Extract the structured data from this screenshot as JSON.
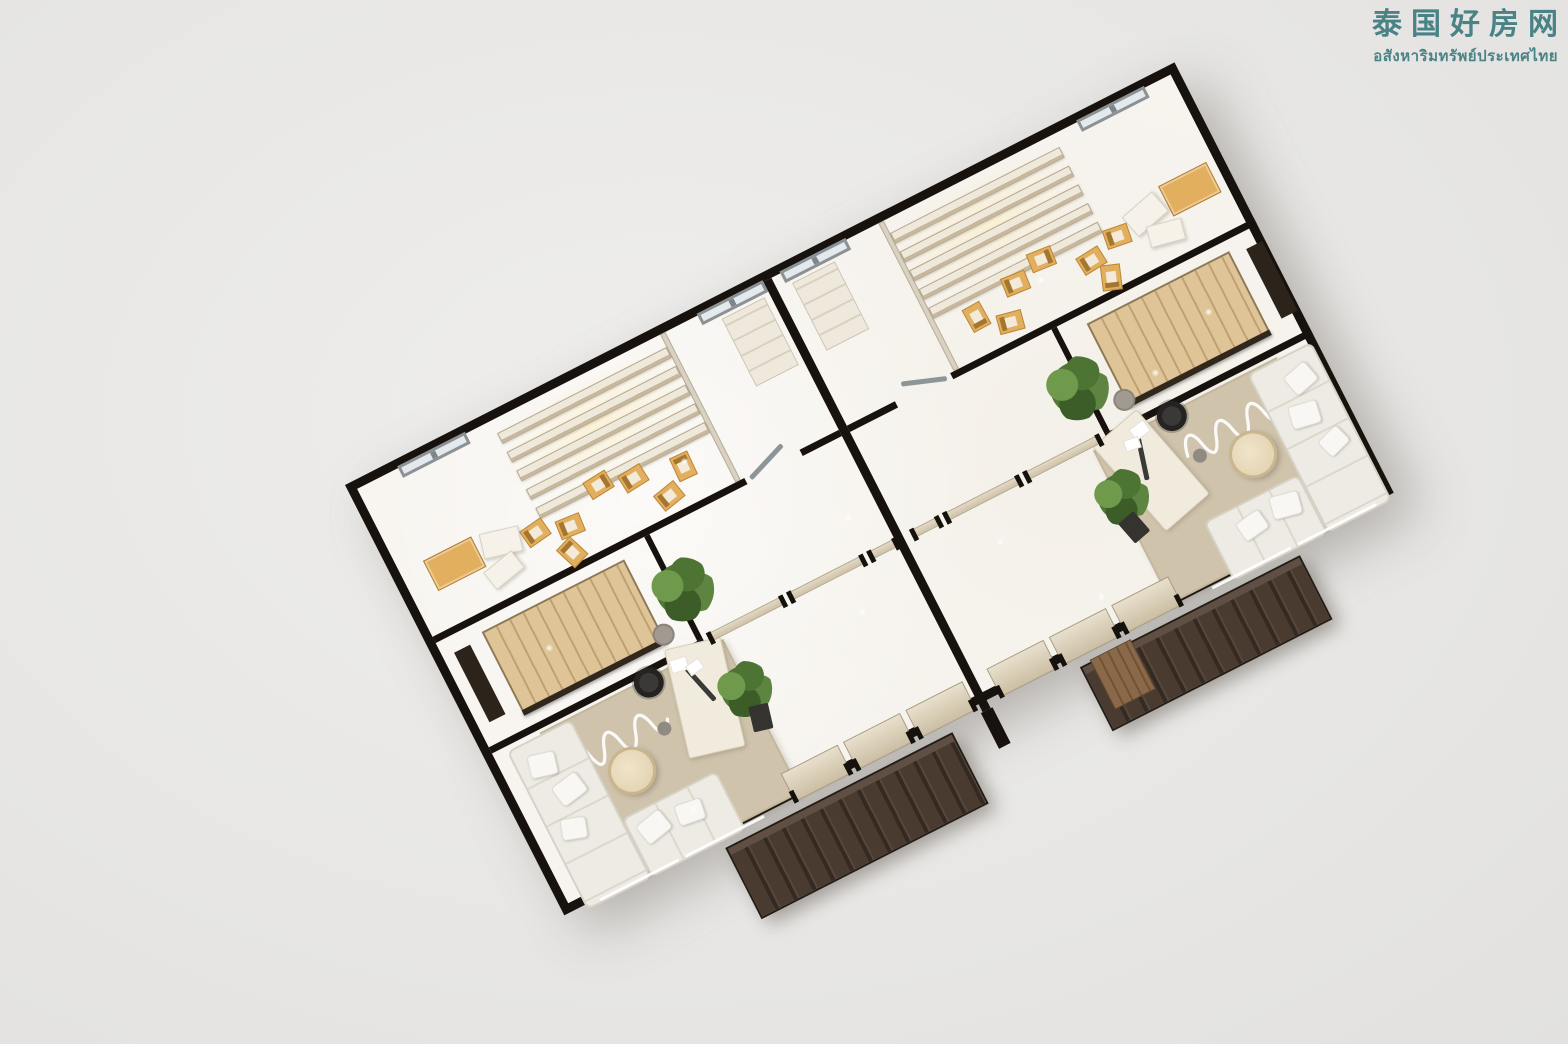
{
  "watermark": {
    "title_zh": "泰国好房网",
    "subtitle_th": "อสังหาริมทรัพย์ประเทศไทย",
    "color": "#3e7c80"
  },
  "palette": {
    "wall": "#17120d",
    "floor": "#f7f4ef",
    "rug": "#cfc3ac",
    "sofa": "#edebe4",
    "wood": "#dfc497",
    "tan": "#e2af5e",
    "awn1": "#4a3b31",
    "awn2": "#342a22",
    "deck": "#8a684a",
    "plant": "#517739",
    "part": "#cfc2a8",
    "wm": "#3e7c80",
    "winframe": "#8b9194"
  },
  "plan": {
    "left": 345,
    "top": 485,
    "width": 931,
    "height": 483,
    "angle_deg": -27,
    "border_px": 9
  },
  "items": [
    {
      "n": "spotlight-glow-left",
      "t": "glow",
      "x": 138,
      "y": 8,
      "w": 214,
      "h": 100
    },
    {
      "n": "spotlight-glow-right",
      "t": "glow",
      "x": 579,
      "y": 8,
      "w": 214,
      "h": 100
    },
    {
      "n": "rug-left-unit",
      "t": "rug",
      "x": 52,
      "y": 300,
      "w": 206,
      "h": 172
    },
    {
      "n": "rug-right-unit",
      "t": "rug",
      "x": 673,
      "y": 300,
      "w": 206,
      "h": 172
    },
    {
      "n": "rug-squiggle-left",
      "t": "squiggle",
      "x": 62,
      "y": 318,
      "w": 120,
      "h": 52
    },
    {
      "n": "rug-squiggle-right",
      "t": "squiggle",
      "x": 749,
      "y": 318,
      "w": 120,
      "h": 52
    },
    {
      "n": "party-wall",
      "t": "wall",
      "x": 456,
      "y": 0,
      "w": 9,
      "h": 483
    },
    {
      "n": "party-wall-stub",
      "t": "stub",
      "x": 454,
      "y": 483,
      "w": 13,
      "h": 40
    },
    {
      "n": "wall-a-left-1",
      "t": "wall",
      "x": 0,
      "y": 166,
      "w": 350,
      "h": 7
    },
    {
      "n": "wall-a-left-2",
      "t": "wall",
      "x": 412,
      "y": 166,
      "w": 44,
      "h": 7
    },
    {
      "n": "wall-a-right-1",
      "t": "wall",
      "x": 465,
      "y": 166,
      "w": 54,
      "h": 7
    },
    {
      "n": "wall-a-right-2",
      "t": "wall",
      "x": 581,
      "y": 166,
      "w": 341,
      "h": 7
    },
    {
      "n": "wall-b-left",
      "t": "wall",
      "x": 0,
      "y": 290,
      "w": 240,
      "h": 7
    },
    {
      "n": "wall-b-right",
      "t": "wall",
      "x": 691,
      "y": 290,
      "w": 231,
      "h": 7
    },
    {
      "n": "stair-wall-left",
      "t": "wall",
      "x": 234,
      "y": 173,
      "w": 6,
      "h": 117
    },
    {
      "n": "stair-wall-right",
      "t": "wall",
      "x": 691,
      "y": 173,
      "w": 6,
      "h": 117
    },
    {
      "n": "backroom-divider-left",
      "t": "wall-light",
      "x": 340,
      "y": 0,
      "w": 6,
      "h": 166
    },
    {
      "n": "backroom-divider-right",
      "t": "wall-light",
      "x": 585,
      "y": 0,
      "w": 6,
      "h": 166
    },
    {
      "n": "door-leaf-left",
      "t": "door",
      "x": 354,
      "y": 159,
      "w": 46,
      "h": 5,
      "r": -20
    },
    {
      "n": "door-leaf-right",
      "t": "door",
      "x": 531,
      "y": 159,
      "w": 46,
      "h": 5,
      "r": 20
    },
    {
      "n": "window-back-left-outer",
      "t": "window",
      "x": 46,
      "y": -2,
      "w": 76,
      "h": 13
    },
    {
      "n": "window-back-left-inner",
      "t": "window",
      "x": 382,
      "y": -2,
      "w": 74,
      "h": 13
    },
    {
      "n": "window-back-right-inner",
      "t": "window",
      "x": 475,
      "y": -2,
      "w": 74,
      "h": 13
    },
    {
      "n": "window-back-right-outer",
      "t": "window",
      "x": 808,
      "y": -2,
      "w": 76,
      "h": 13
    },
    {
      "n": "shelf-row-left-1",
      "t": "shelfrow",
      "x": 150,
      "y": 14,
      "w": 190,
      "h": 12
    },
    {
      "n": "shelf-row-left-2",
      "t": "shelfrow",
      "x": 150,
      "y": 35,
      "w": 190,
      "h": 12
    },
    {
      "n": "shelf-row-left-3",
      "t": "shelfrow",
      "x": 150,
      "y": 56,
      "w": 190,
      "h": 12
    },
    {
      "n": "shelf-row-left-4",
      "t": "shelfrow",
      "x": 150,
      "y": 77,
      "w": 190,
      "h": 12
    },
    {
      "n": "shelf-row-left-5",
      "t": "shelfrow",
      "x": 150,
      "y": 98,
      "w": 190,
      "h": 12
    },
    {
      "n": "shelf-row-right-1",
      "t": "shelfrow",
      "x": 591,
      "y": 14,
      "w": 190,
      "h": 12
    },
    {
      "n": "shelf-row-right-2",
      "t": "shelfrow",
      "x": 591,
      "y": 35,
      "w": 190,
      "h": 12
    },
    {
      "n": "shelf-row-right-3",
      "t": "shelfrow",
      "x": 591,
      "y": 56,
      "w": 190,
      "h": 12
    },
    {
      "n": "shelf-row-right-4",
      "t": "shelfrow",
      "x": 591,
      "y": 77,
      "w": 190,
      "h": 12
    },
    {
      "n": "shelf-row-right-5",
      "t": "shelfrow",
      "x": 591,
      "y": 98,
      "w": 190,
      "h": 12
    },
    {
      "n": "display-cabinet-left",
      "t": "cabinet",
      "x": 26,
      "y": 94,
      "w": 54,
      "h": 34
    },
    {
      "n": "display-cabinet-right",
      "t": "cabinet",
      "x": 851,
      "y": 94,
      "w": 54,
      "h": 34
    },
    {
      "n": "display-plinth-left-1",
      "t": "plinth",
      "x": 84,
      "y": 100,
      "w": 40,
      "h": 26,
      "r": 14
    },
    {
      "n": "display-plinth-left-2",
      "t": "plinth",
      "x": 76,
      "y": 128,
      "w": 36,
      "h": 22,
      "r": -12
    },
    {
      "n": "display-plinth-right-1",
      "t": "plinth",
      "x": 807,
      "y": 100,
      "w": 40,
      "h": 26,
      "r": -14
    },
    {
      "n": "display-plinth-right-2",
      "t": "plinth",
      "x": 819,
      "y": 128,
      "w": 36,
      "h": 22,
      "r": 12
    },
    {
      "n": "tan-chair-left-1",
      "t": "chair-tan",
      "x": 126,
      "y": 110,
      "w": 26,
      "h": 20,
      "r": -8
    },
    {
      "n": "tan-chair-left-2",
      "t": "chair-tan",
      "x": 160,
      "y": 120,
      "w": 26,
      "h": 20,
      "r": 5
    },
    {
      "n": "tan-chair-left-3",
      "t": "chair-tan",
      "x": 204,
      "y": 96,
      "w": 26,
      "h": 20,
      "r": 175
    },
    {
      "n": "tan-chair-left-4",
      "t": "chair-tan",
      "x": 238,
      "y": 106,
      "w": 26,
      "h": 20,
      "r": -5
    },
    {
      "n": "tan-chair-left-5",
      "t": "chair-tan",
      "x": 150,
      "y": 144,
      "w": 26,
      "h": 20,
      "r": 70
    },
    {
      "n": "tan-chair-left-6",
      "t": "chair-tan",
      "x": 262,
      "y": 138,
      "w": 26,
      "h": 20,
      "r": -12
    },
    {
      "n": "tan-chair-left-7",
      "t": "chair-tan",
      "x": 288,
      "y": 118,
      "w": 26,
      "h": 20,
      "r": 92
    },
    {
      "n": "tan-chair-right-1",
      "t": "chair-tan",
      "x": 779,
      "y": 110,
      "w": 26,
      "h": 20,
      "r": 8
    },
    {
      "n": "tan-chair-right-2",
      "t": "chair-tan",
      "x": 745,
      "y": 120,
      "w": 26,
      "h": 20,
      "r": -5
    },
    {
      "n": "tan-chair-right-3",
      "t": "chair-tan",
      "x": 701,
      "y": 96,
      "w": 26,
      "h": 20,
      "r": -175
    },
    {
      "n": "tan-chair-right-4",
      "t": "chair-tan",
      "x": 667,
      "y": 106,
      "w": 26,
      "h": 20,
      "r": 5
    },
    {
      "n": "tan-chair-right-5",
      "t": "chair-tan",
      "x": 755,
      "y": 144,
      "w": 26,
      "h": 20,
      "r": -70
    },
    {
      "n": "tan-chair-right-6",
      "t": "chair-tan",
      "x": 645,
      "y": 138,
      "w": 26,
      "h": 20,
      "r": 12
    },
    {
      "n": "tan-chair-right-7",
      "t": "chair-tan",
      "x": 617,
      "y": 118,
      "w": 26,
      "h": 20,
      "r": -92
    },
    {
      "n": "storage-closet-left",
      "t": "closet",
      "x": 402,
      "y": 14,
      "w": 48,
      "h": 76
    },
    {
      "n": "storage-closet-right",
      "t": "closet",
      "x": 481,
      "y": 14,
      "w": 48,
      "h": 76
    },
    {
      "n": "staircase-left",
      "t": "stairs",
      "x": 46,
      "y": 184,
      "w": 160,
      "h": 92
    },
    {
      "n": "staircase-right",
      "t": "stairs",
      "x": 725,
      "y": 184,
      "w": 160,
      "h": 92
    },
    {
      "n": "stair-railing-left",
      "t": "rail",
      "x": 46,
      "y": 272,
      "w": 160,
      "h": 6
    },
    {
      "n": "stair-railing-right",
      "t": "rail",
      "x": 725,
      "y": 272,
      "w": 160,
      "h": 6
    },
    {
      "n": "stair-console-left",
      "t": "console",
      "x": 12,
      "y": 190,
      "w": 18,
      "h": 78
    },
    {
      "n": "stair-console-right",
      "t": "console",
      "x": 901,
      "y": 190,
      "w": 18,
      "h": 78
    },
    {
      "n": "stair-plant-left",
      "t": "plant",
      "x": 212,
      "y": 205,
      "w": 64,
      "h": 64
    },
    {
      "n": "stair-plant-right",
      "t": "plant",
      "x": 655,
      "y": 205,
      "w": 64,
      "h": 64
    },
    {
      "n": "sofa-left-vertical",
      "t": "sofa-v",
      "x": 14,
      "y": 302,
      "w": 72,
      "h": 178
    },
    {
      "n": "sofa-left-front",
      "t": "sofa-h",
      "x": 86,
      "y": 414,
      "w": 106,
      "h": 66
    },
    {
      "n": "sofa-right-vertical",
      "t": "sofa-v",
      "x": 845,
      "y": 302,
      "w": 72,
      "h": 178
    },
    {
      "n": "sofa-right-front",
      "t": "sofa-h",
      "x": 739,
      "y": 414,
      "w": 106,
      "h": 66
    },
    {
      "n": "pillow-left-1",
      "t": "pillow",
      "x": 26,
      "y": 318,
      "w": 28,
      "h": 24,
      "r": 14
    },
    {
      "n": "pillow-left-2",
      "t": "pillow",
      "x": 38,
      "y": 352,
      "w": 30,
      "h": 24,
      "r": -10
    },
    {
      "n": "pillow-left-3",
      "t": "pillow",
      "x": 26,
      "y": 390,
      "w": 26,
      "h": 22,
      "r": 18
    },
    {
      "n": "pillow-left-4",
      "t": "pillow",
      "x": 96,
      "y": 424,
      "w": 30,
      "h": 24,
      "r": -12
    },
    {
      "n": "pillow-left-5",
      "t": "pillow",
      "x": 136,
      "y": 428,
      "w": 28,
      "h": 22,
      "r": 8
    },
    {
      "n": "pillow-right-1",
      "t": "pillow",
      "x": 877,
      "y": 318,
      "w": 28,
      "h": 24,
      "r": -14
    },
    {
      "n": "pillow-right-2",
      "t": "pillow",
      "x": 863,
      "y": 352,
      "w": 30,
      "h": 24,
      "r": 10
    },
    {
      "n": "pillow-right-3",
      "t": "pillow",
      "x": 879,
      "y": 390,
      "w": 26,
      "h": 22,
      "r": -18
    },
    {
      "n": "pillow-right-4",
      "t": "pillow",
      "x": 805,
      "y": 424,
      "w": 30,
      "h": 24,
      "r": 12
    },
    {
      "n": "pillow-right-5",
      "t": "pillow",
      "x": 767,
      "y": 428,
      "w": 28,
      "h": 22,
      "r": -8
    },
    {
      "n": "coffee-table-left",
      "t": "table-round",
      "x": 93,
      "y": 352,
      "w": 48,
      "h": 48
    },
    {
      "n": "coffee-table-right",
      "t": "table-round",
      "x": 790,
      "y": 352,
      "w": 48,
      "h": 48
    },
    {
      "n": "work-desk-left",
      "t": "desk",
      "x": 186,
      "y": 288,
      "w": 58,
      "h": 112,
      "r": 14
    },
    {
      "n": "work-desk-right",
      "t": "desk",
      "x": 687,
      "y": 288,
      "w": 58,
      "h": 112,
      "r": -14
    },
    {
      "n": "desk-monitor-left",
      "t": "bar",
      "x": 194,
      "y": 326,
      "w": 46,
      "h": 5,
      "r": 75
    },
    {
      "n": "desk-monitor-right",
      "t": "bar",
      "x": 691,
      "y": 326,
      "w": 46,
      "h": 5,
      "r": -75
    },
    {
      "n": "desk-paper-left-1",
      "t": "paper",
      "x": 198,
      "y": 296,
      "w": 18,
      "h": 14,
      "r": 10
    },
    {
      "n": "desk-paper-left-2",
      "t": "paper",
      "x": 212,
      "y": 306,
      "w": 16,
      "h": 12,
      "r": -8
    },
    {
      "n": "desk-paper-right-1",
      "t": "paper",
      "x": 715,
      "y": 296,
      "w": 18,
      "h": 14,
      "r": -10
    },
    {
      "n": "desk-paper-right-2",
      "t": "paper",
      "x": 703,
      "y": 306,
      "w": 16,
      "h": 12,
      "r": 8
    },
    {
      "n": "office-chair-left",
      "t": "office-chair",
      "x": 157,
      "y": 290,
      "w": 30,
      "h": 30
    },
    {
      "n": "office-chair-right",
      "t": "office-chair",
      "x": 744,
      "y": 290,
      "w": 30,
      "h": 30
    },
    {
      "n": "stool-left",
      "t": "stool",
      "x": 196,
      "y": 258,
      "w": 22,
      "h": 22
    },
    {
      "n": "stool-right",
      "t": "stool",
      "x": 713,
      "y": 258,
      "w": 22,
      "h": 22
    },
    {
      "n": "desk-plant-left",
      "t": "plant",
      "x": 226,
      "y": 326,
      "w": 56,
      "h": 56
    },
    {
      "n": "desk-plant-right",
      "t": "plant",
      "x": 649,
      "y": 326,
      "w": 56,
      "h": 56
    },
    {
      "n": "desk-cart-left",
      "t": "cart",
      "x": 246,
      "y": 374,
      "w": 20,
      "h": 26,
      "r": 14
    },
    {
      "n": "desk-cart-right",
      "t": "cart",
      "x": 665,
      "y": 374,
      "w": 20,
      "h": 26,
      "r": -14
    },
    {
      "n": "floor-pot-left",
      "t": "pot",
      "x": 158,
      "y": 346,
      "w": 14,
      "h": 14
    },
    {
      "n": "floor-pot-right",
      "t": "pot",
      "x": 759,
      "y": 346,
      "w": 14,
      "h": 14
    },
    {
      "n": "partition-left-1",
      "t": "partition",
      "x": 246,
      "y": 288,
      "w": 84,
      "h": 9
    },
    {
      "n": "partition-left-2",
      "t": "partition",
      "x": 336,
      "y": 288,
      "w": 84,
      "h": 9
    },
    {
      "n": "partition-left-3",
      "t": "partition",
      "x": 426,
      "y": 288,
      "w": 31,
      "h": 9
    },
    {
      "n": "partition-right-1",
      "t": "partition",
      "x": 474,
      "y": 288,
      "w": 31,
      "h": 9
    },
    {
      "n": "partition-right-2",
      "t": "partition",
      "x": 511,
      "y": 288,
      "w": 84,
      "h": 9
    },
    {
      "n": "partition-right-3",
      "t": "partition",
      "x": 601,
      "y": 288,
      "w": 84,
      "h": 9
    },
    {
      "n": "facade-panel-left-1",
      "t": "facade",
      "x": 248,
      "y": 446,
      "w": 64,
      "h": 32
    },
    {
      "n": "facade-panel-left-2",
      "t": "facade",
      "x": 318,
      "y": 446,
      "w": 64,
      "h": 32
    },
    {
      "n": "facade-panel-left-3",
      "t": "facade",
      "x": 388,
      "y": 446,
      "w": 64,
      "h": 32
    },
    {
      "n": "facade-panel-right-1",
      "t": "facade",
      "x": 479,
      "y": 446,
      "w": 64,
      "h": 32
    },
    {
      "n": "facade-panel-right-2",
      "t": "facade",
      "x": 549,
      "y": 446,
      "w": 64,
      "h": 32
    },
    {
      "n": "facade-panel-right-3",
      "t": "facade",
      "x": 619,
      "y": 446,
      "w": 64,
      "h": 32
    },
    {
      "n": "glazing-slit-left-1",
      "t": "slit",
      "x": 30,
      "y": 475,
      "w": 88,
      "h": 3
    },
    {
      "n": "glazing-slit-left-2",
      "t": "slit",
      "x": 126,
      "y": 475,
      "w": 88,
      "h": 3
    },
    {
      "n": "glazing-slit-right-1",
      "t": "slit",
      "x": 717,
      "y": 475,
      "w": 88,
      "h": 3
    },
    {
      "n": "glazing-slit-right-2",
      "t": "slit",
      "x": 813,
      "y": 475,
      "w": 88,
      "h": 3
    },
    {
      "n": "awning-left",
      "t": "awning",
      "x": 165,
      "y": 487,
      "w": 255,
      "h": 80
    },
    {
      "n": "awning-right",
      "t": "awning",
      "x": 563,
      "y": 487,
      "w": 247,
      "h": 72
    },
    {
      "n": "wood-deck-right",
      "t": "deck",
      "x": 575,
      "y": 485,
      "w": 46,
      "h": 56
    },
    {
      "n": "floor-sparkle-1",
      "t": "sparkle",
      "x": 300,
      "y": 120,
      "w": 8,
      "h": 8
    },
    {
      "n": "floor-sparkle-2",
      "t": "sparkle",
      "x": 95,
      "y": 225,
      "w": 8,
      "h": 8
    },
    {
      "n": "floor-sparkle-3",
      "t": "sparkle",
      "x": 390,
      "y": 335,
      "w": 8,
      "h": 8
    },
    {
      "n": "floor-sparkle-4",
      "t": "sparkle",
      "x": 150,
      "y": 435,
      "w": 8,
      "h": 8
    },
    {
      "n": "floor-sparkle-5",
      "t": "sparkle",
      "x": 420,
      "y": 245,
      "w": 8,
      "h": 8
    },
    {
      "n": "floor-sparkle-6",
      "t": "sparkle",
      "x": 700,
      "y": 120,
      "w": 8,
      "h": 8
    },
    {
      "n": "floor-sparkle-7",
      "t": "sparkle",
      "x": 835,
      "y": 225,
      "w": 8,
      "h": 8
    },
    {
      "n": "floor-sparkle-8",
      "t": "sparkle",
      "x": 545,
      "y": 335,
      "w": 8,
      "h": 8
    },
    {
      "n": "floor-sparkle-9",
      "t": "sparkle",
      "x": 760,
      "y": 255,
      "w": 8,
      "h": 8
    },
    {
      "n": "floor-sparkle-10",
      "t": "sparkle",
      "x": 610,
      "y": 430,
      "w": 8,
      "h": 8
    }
  ]
}
